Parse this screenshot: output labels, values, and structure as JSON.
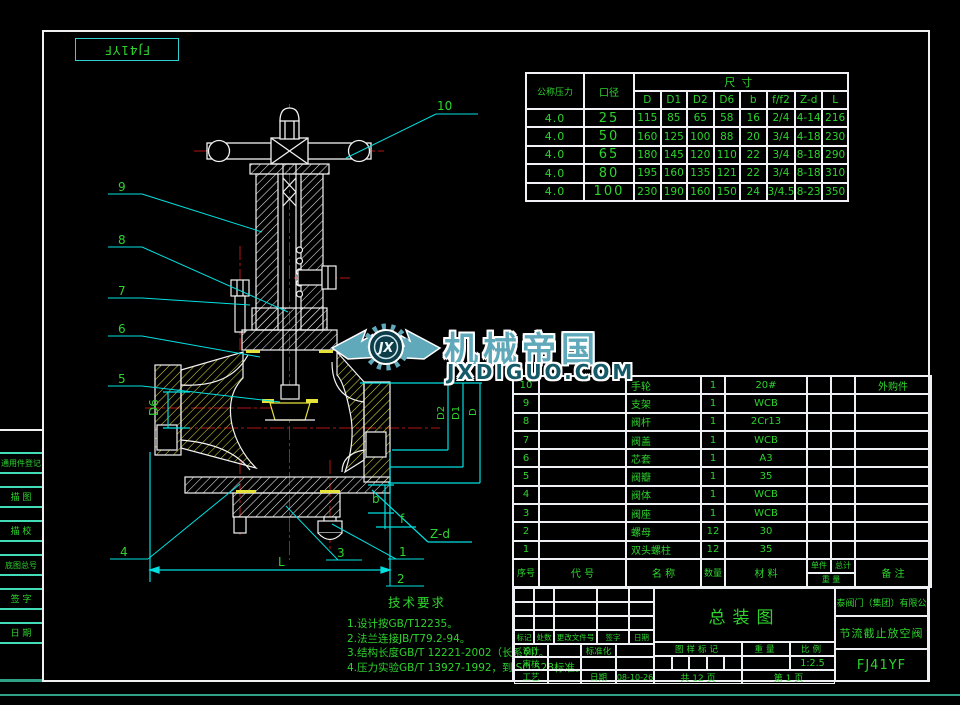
{
  "frame": {
    "corner_model": "FJ41YF",
    "edge_stamps": [
      "通用件登记",
      "描 图",
      "描 校",
      "底图总号",
      "签 字",
      "日 期"
    ]
  },
  "dim_table": {
    "header_pressure": "公称压力",
    "header_bore": "口径",
    "header_size": "尺寸",
    "sub_headers": [
      "D",
      "D1",
      "D2",
      "D6",
      "b",
      "f/f2",
      "Z-d",
      "L"
    ],
    "rows": [
      {
        "pressure": "4.0",
        "bore": "25",
        "dims": [
          "115",
          "85",
          "65",
          "58",
          "16",
          "2/4",
          "4-14",
          "216"
        ]
      },
      {
        "pressure": "4.0",
        "bore": "50",
        "dims": [
          "160",
          "125",
          "100",
          "88",
          "20",
          "3/4",
          "4-18",
          "230"
        ]
      },
      {
        "pressure": "4.0",
        "bore": "65",
        "dims": [
          "180",
          "145",
          "120",
          "110",
          "22",
          "3/4",
          "8-18",
          "290"
        ]
      },
      {
        "pressure": "4.0",
        "bore": "80",
        "dims": [
          "195",
          "160",
          "135",
          "121",
          "22",
          "3/4",
          "8-18",
          "310"
        ]
      },
      {
        "pressure": "4.0",
        "bore": "100",
        "dims": [
          "230",
          "190",
          "160",
          "150",
          "24",
          "3/4.5",
          "8-23",
          "350"
        ]
      }
    ]
  },
  "watermark": {
    "monogram": "JX",
    "brand": "机械帝国",
    "site": "JXDIGUO.COM"
  },
  "balloons": {
    "b1": "1",
    "b2": "2",
    "b3": "3",
    "b4": "4",
    "b5": "5",
    "b6": "6",
    "b7": "7",
    "b8": "8",
    "b9": "9",
    "b10": "10"
  },
  "dim_labels": {
    "L": "L",
    "b": "b",
    "f": "f",
    "zd": "Z-d",
    "d6": "D6",
    "d2": "D2",
    "d1": "D1",
    "d": "D"
  },
  "bom": {
    "headers": {
      "no": "序号",
      "code": "代  号",
      "name": "名  称",
      "qty": "数量",
      "material": "材  料",
      "unit": "单件",
      "total": "总计",
      "weight": "重  量",
      "remark": "备  注"
    },
    "rows": [
      {
        "no": "10",
        "code": "",
        "name": "手轮",
        "qty": "1",
        "material": "20#",
        "remark": "外购件"
      },
      {
        "no": "9",
        "code": "",
        "name": "支架",
        "qty": "1",
        "material": "WCB",
        "remark": ""
      },
      {
        "no": "8",
        "code": "",
        "name": "阀杆",
        "qty": "1",
        "material": "2Cr13",
        "remark": ""
      },
      {
        "no": "7",
        "code": "",
        "name": "阀盖",
        "qty": "1",
        "material": "WCB",
        "remark": ""
      },
      {
        "no": "6",
        "code": "",
        "name": "芯套",
        "qty": "1",
        "material": "A3",
        "remark": ""
      },
      {
        "no": "5",
        "code": "",
        "name": "阀瓣",
        "qty": "1",
        "material": "35",
        "remark": ""
      },
      {
        "no": "4",
        "code": "",
        "name": "阀体",
        "qty": "1",
        "material": "WCB",
        "remark": ""
      },
      {
        "no": "3",
        "code": "",
        "name": "阀座",
        "qty": "1",
        "material": "WCB",
        "remark": ""
      },
      {
        "no": "2",
        "code": "",
        "name": "螺母",
        "qty": "12",
        "material": "30",
        "remark": ""
      },
      {
        "no": "1",
        "code": "",
        "name": "双头螺柱",
        "qty": "12",
        "material": "35",
        "remark": ""
      }
    ]
  },
  "title_block": {
    "drawing_title": "总装图",
    "company": "凯泰阀门（集团）有限公司",
    "product": "节流截止放空阀",
    "model": "FJ41YF",
    "rev_headers": [
      "标记",
      "处数",
      "更改文件号",
      "签字",
      "日期"
    ],
    "role_design": "设计",
    "role_standard": "标准化",
    "role_check": "审核",
    "role_process": "工艺",
    "label_date": "日期",
    "stamp_header": "图样标记",
    "weight_header": "重量",
    "scale_header": "比例",
    "scale": "1:2.5",
    "date": "08-10-26",
    "sheet_total": "共 12 页",
    "sheet_no": "第 1 页"
  },
  "tech_req": {
    "title": "技术要求",
    "items": [
      "1.设计按GB/T12235。",
      "2.法兰连接JB/T79.2-94。",
      "3.结构长度GB/T 12221-2002（长系列）。",
      "4.压力实验GB/T 13927-1992，到ISO 528标准。"
    ]
  }
}
